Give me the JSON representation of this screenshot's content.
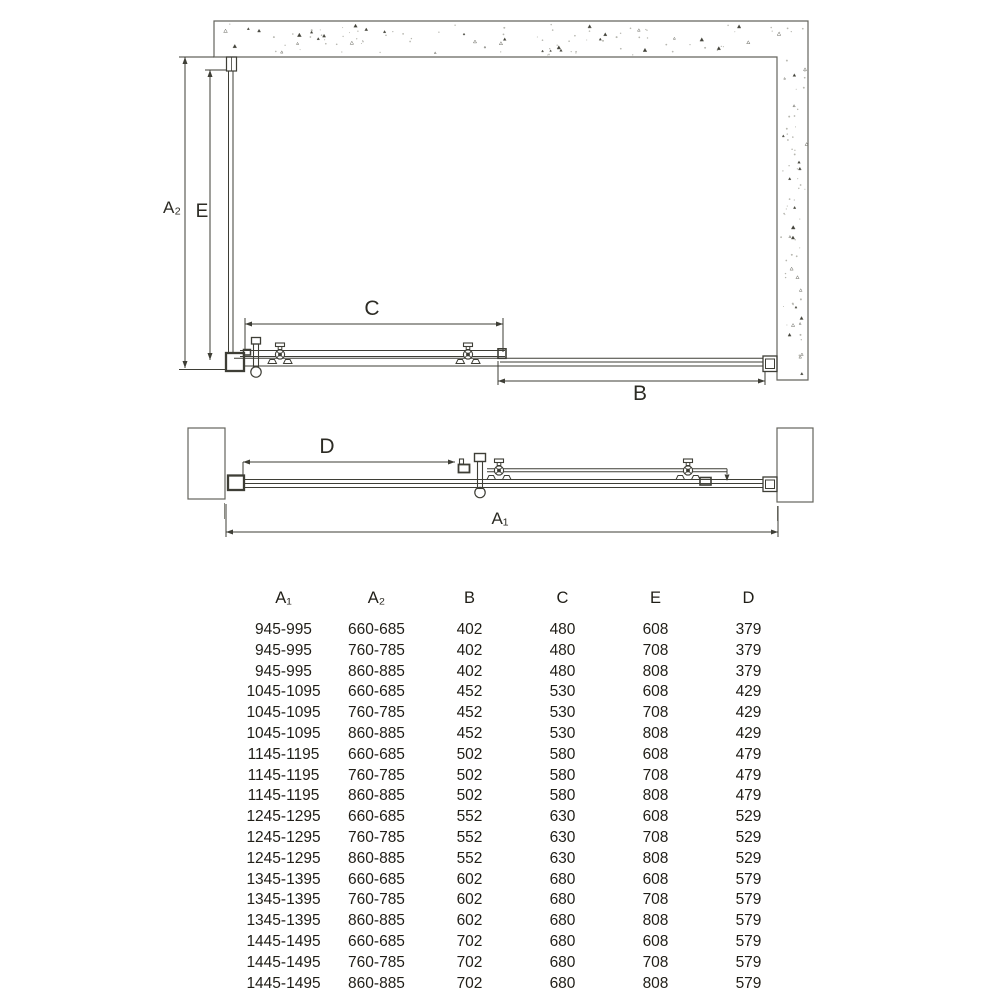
{
  "diagram": {
    "labels": {
      "a2": "A₂",
      "e": "E",
      "c": "C",
      "b": "B",
      "d": "D",
      "a1": "A₁"
    },
    "colors": {
      "line": "#3e3e36",
      "wall_outline": "#65655d",
      "speck": "#6a6a62"
    }
  },
  "table": {
    "headers": [
      "A₁",
      "A₂",
      "B",
      "C",
      "E",
      "D"
    ],
    "rows": [
      [
        "945-995",
        "660-685",
        "402",
        "480",
        "608",
        "379"
      ],
      [
        "945-995",
        "760-785",
        "402",
        "480",
        "708",
        "379"
      ],
      [
        "945-995",
        "860-885",
        "402",
        "480",
        "808",
        "379"
      ],
      [
        "1045-1095",
        "660-685",
        "452",
        "530",
        "608",
        "429"
      ],
      [
        "1045-1095",
        "760-785",
        "452",
        "530",
        "708",
        "429"
      ],
      [
        "1045-1095",
        "860-885",
        "452",
        "530",
        "808",
        "429"
      ],
      [
        "1145-1195",
        "660-685",
        "502",
        "580",
        "608",
        "479"
      ],
      [
        "1145-1195",
        "760-785",
        "502",
        "580",
        "708",
        "479"
      ],
      [
        "1145-1195",
        "860-885",
        "502",
        "580",
        "808",
        "479"
      ],
      [
        "1245-1295",
        "660-685",
        "552",
        "630",
        "608",
        "529"
      ],
      [
        "1245-1295",
        "760-785",
        "552",
        "630",
        "708",
        "529"
      ],
      [
        "1245-1295",
        "860-885",
        "552",
        "630",
        "808",
        "529"
      ],
      [
        "1345-1395",
        "660-685",
        "602",
        "680",
        "608",
        "579"
      ],
      [
        "1345-1395",
        "760-785",
        "602",
        "680",
        "708",
        "579"
      ],
      [
        "1345-1395",
        "860-885",
        "602",
        "680",
        "808",
        "579"
      ],
      [
        "1445-1495",
        "660-685",
        "702",
        "680",
        "608",
        "579"
      ],
      [
        "1445-1495",
        "760-785",
        "702",
        "680",
        "708",
        "579"
      ],
      [
        "1445-1495",
        "860-885",
        "702",
        "680",
        "808",
        "579"
      ]
    ]
  }
}
